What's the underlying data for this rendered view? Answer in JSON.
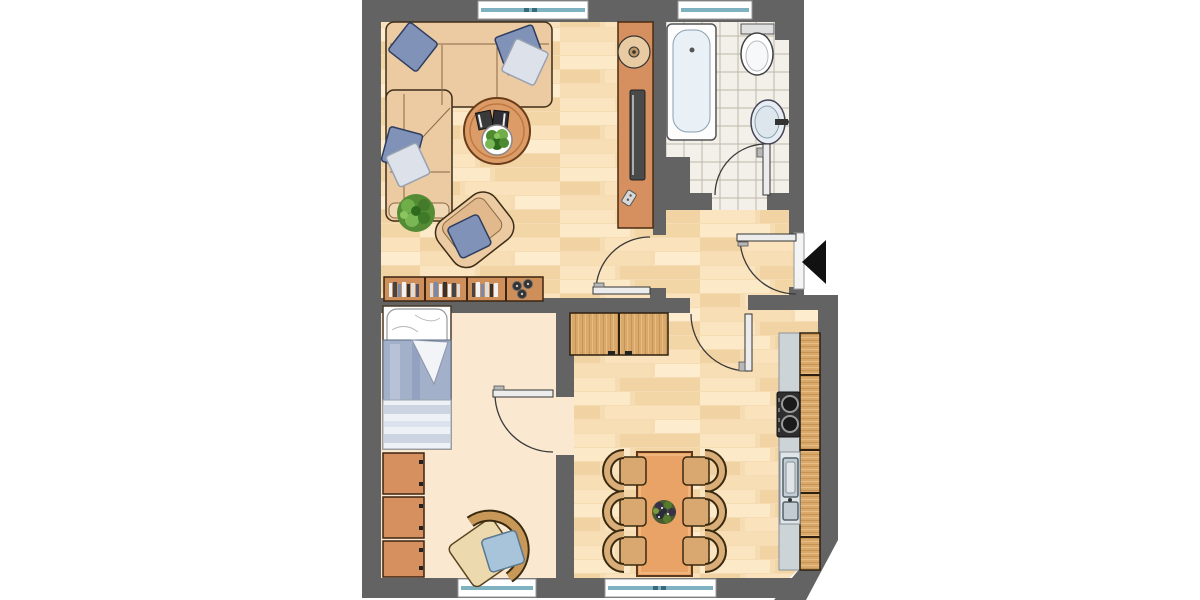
{
  "app": {
    "type": "apartment-floor-plan",
    "view": "top-down architectural drawing",
    "canvas": {
      "width": 1200,
      "height": 600
    }
  },
  "palette": {
    "wall": "#636363",
    "outside": "#ffffff",
    "parquet_base": "#f6dcb2",
    "bedroom_floor": "#fae9d0",
    "tile_floor": "#f3f0e9",
    "furniture_orange": "#d6905f",
    "table_orange": "#e9a366",
    "wood_cabinet": "#d9a96b",
    "sofa_tan": "#eccba2",
    "pillow_blue": "#8092b8",
    "pillow_light": "#dde1ea",
    "window_teal": "#7fb2c0",
    "counter_gray": "#ccd4d8",
    "stove_dark": "#2e2e2e",
    "plant_green": "#5f9e3e",
    "entrance_arrow": "#111111"
  },
  "plan": {
    "entrance_marker": "black-left-arrow",
    "door_count": 5,
    "window_count": 4,
    "rooms": [
      {
        "name": "living-room",
        "floor": "parquet",
        "furniture": [
          "corner-sofa",
          "sofa-pillows",
          "coffee-table",
          "books",
          "potted-plant",
          "floor-plant",
          "armchair",
          "bookshelf-sideboard",
          "tv-lowboard",
          "tv",
          "speaker-bowl",
          "remote-control"
        ],
        "windows": 1,
        "doors": [
          "to-hallway"
        ]
      },
      {
        "name": "bathroom",
        "floor": "tiles",
        "furniture": [
          "bathtub",
          "toilet",
          "wash-basin"
        ],
        "windows": 1,
        "doors": [
          "to-hallway"
        ]
      },
      {
        "name": "hallway",
        "floor": "parquet",
        "furniture": [],
        "windows": 0,
        "doors": [
          "entrance",
          "to-living-room",
          "to-bathroom",
          "to-kitchen"
        ]
      },
      {
        "name": "bedroom",
        "floor": "plain",
        "furniture": [
          "single-bed",
          "wardrobe-3-units",
          "wicker-chair"
        ],
        "windows": 1,
        "doors": [
          "to-kitchen"
        ]
      },
      {
        "name": "kitchen-dining",
        "floor": "parquet",
        "furniture": [
          "sideboard",
          "dining-table",
          "six-chairs",
          "table-centerpiece",
          "stove",
          "double-sink",
          "counter",
          "cabinet-row"
        ],
        "windows": 1,
        "doors": [
          "to-hallway",
          "to-bedroom"
        ]
      }
    ]
  }
}
